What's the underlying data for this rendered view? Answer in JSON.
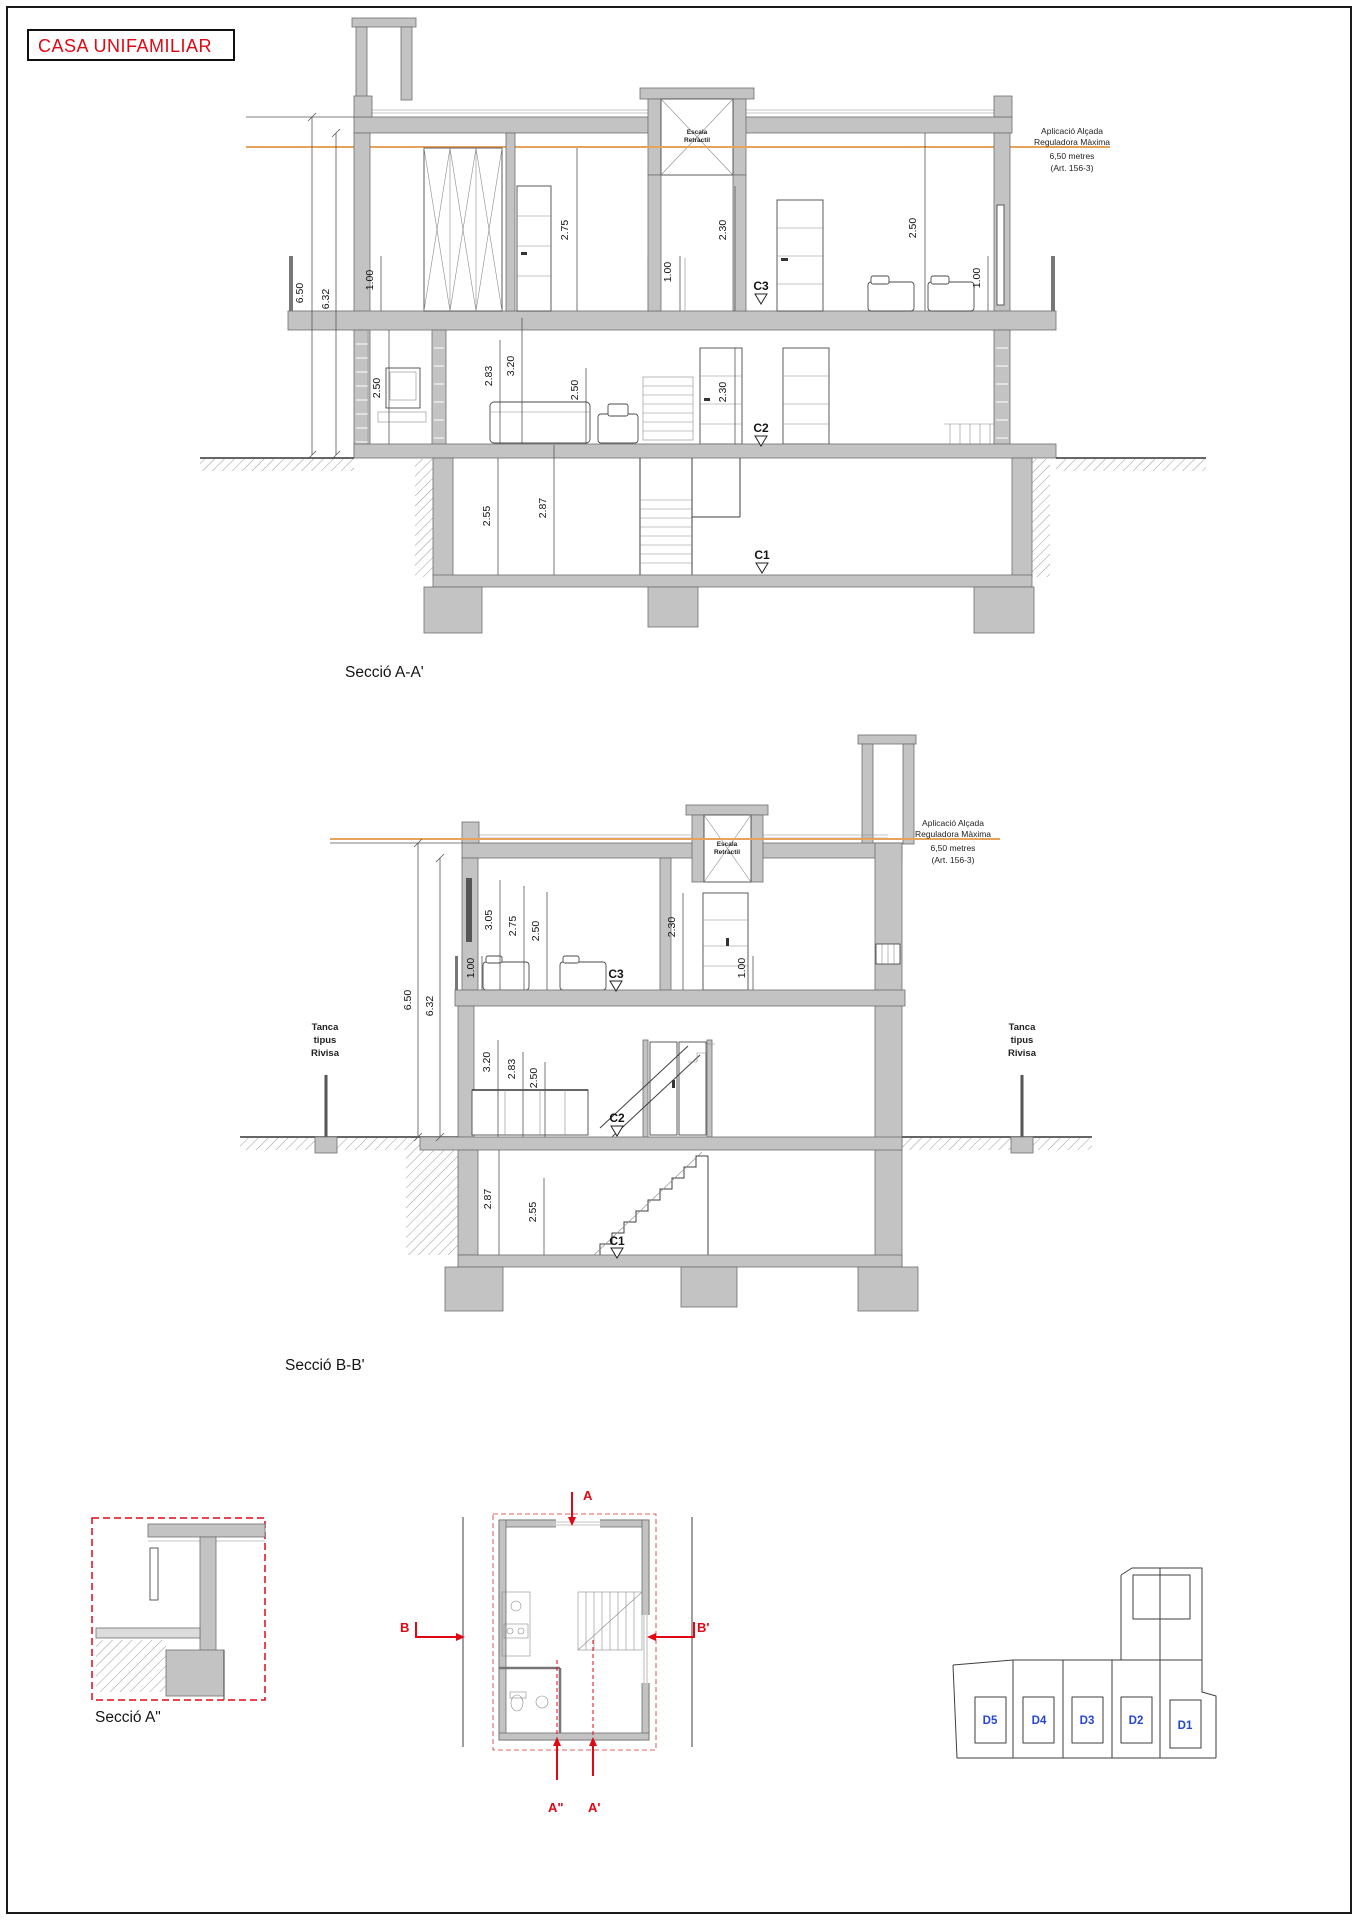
{
  "page": {
    "title": "CASA UNIFAMILIAR",
    "colors": {
      "red": "#e30613",
      "blue": "#2446d2",
      "orange": "#e6a35c",
      "slab_gray": "#c3c3c3"
    }
  },
  "annotation": [
    "Aplicació Alçada",
    "Reguladora Màxima",
    "6,50 metres",
    "(Art. 156-3)"
  ],
  "elevator": [
    "Escala",
    "Retràctil"
  ],
  "fence": [
    "Tanca",
    "tipus",
    "Rivisa"
  ],
  "section_aa": {
    "caption": "Secció A-A'",
    "levels": {
      "c1": "C1",
      "c2": "C2",
      "c3": "C3"
    },
    "dims": {
      "total": "6.50",
      "inner": "6.32",
      "ff_rail_left": "1.00",
      "ff_wardrobe": "2.75",
      "ff_rail_mid": "1.00",
      "ff_door": "2.30",
      "ff_room": "2.50",
      "ff_rail_right": "1.00",
      "gf_fireplace": "2.50",
      "gf_beam": "2.83",
      "gf_ceiling": "3.20",
      "gf_room": "2.50",
      "gf_door": "2.30",
      "bm_clear": "2.55",
      "bm_total": "2.87"
    }
  },
  "section_bb": {
    "caption": "Secció B-B'",
    "levels": {
      "c1": "C1",
      "c2": "C2",
      "c3": "C3"
    },
    "dims": {
      "total": "6.50",
      "inner": "6.32",
      "ff_rail_left": "1.00",
      "ff_a": "3.05",
      "ff_b": "2.75",
      "ff_c": "2.50",
      "ff_door": "2.30",
      "ff_sill": "1.00",
      "gf_a": "3.20",
      "gf_b": "2.83",
      "gf_c": "2.50",
      "bm_total": "2.87",
      "bm_clear": "2.55"
    }
  },
  "section_a2": {
    "caption": "Secció A\""
  },
  "floor_plan": {
    "markers": {
      "a": "A",
      "a_prime": "A'",
      "a_dbl": "A\"",
      "b": "B",
      "b_prime": "B'"
    }
  },
  "site_plan": {
    "plots": [
      "D5",
      "D4",
      "D3",
      "D2",
      "D1"
    ]
  }
}
